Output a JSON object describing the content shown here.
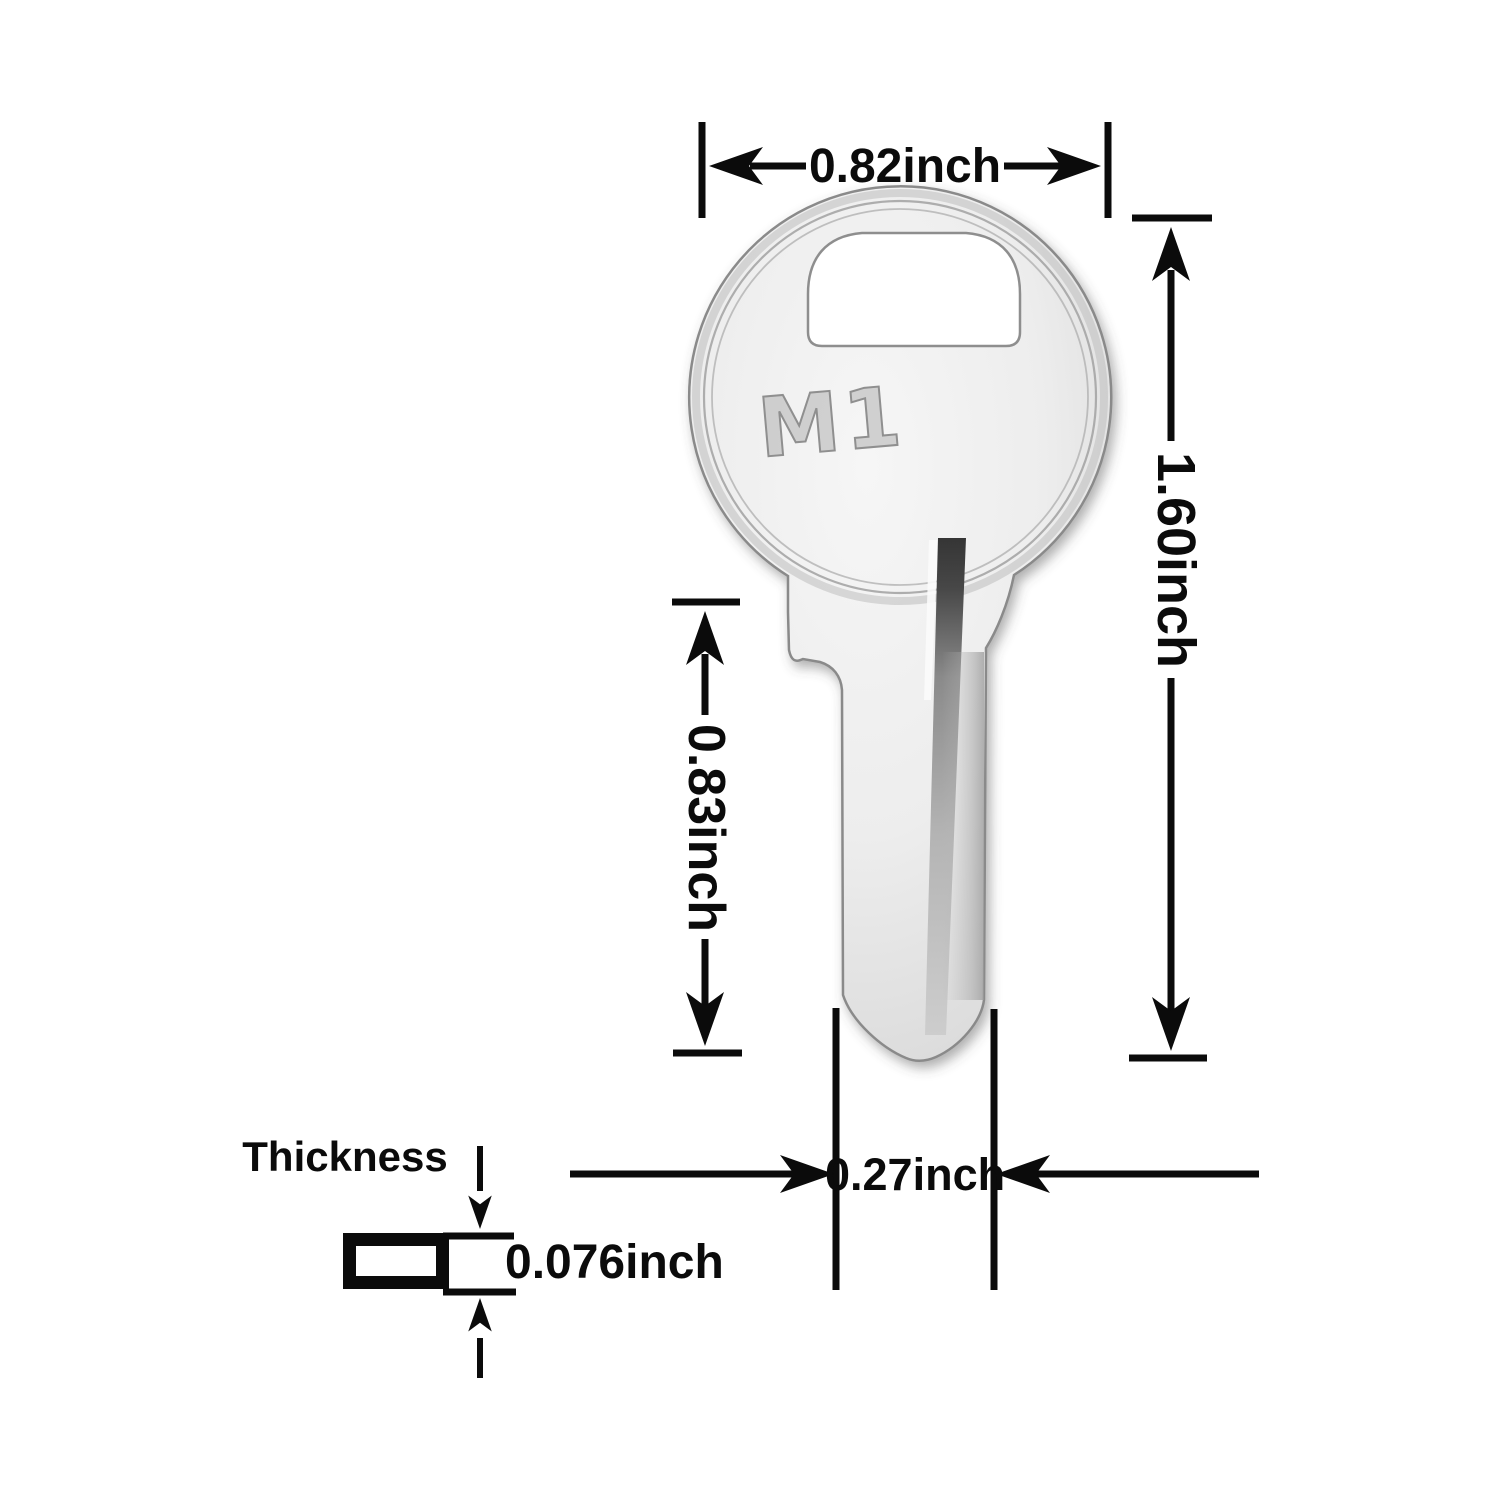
{
  "image": {
    "description": "Key blank dimension diagram",
    "background": "#ffffff",
    "annotation_color": "#0b0b0b",
    "metal_light": "#f3f3f3",
    "metal_mid": "#e2e2e2",
    "metal_dark": "#c9c9c9",
    "groove_dark": "#3c3c3c"
  },
  "key": {
    "stamp": "M1"
  },
  "dimensions": {
    "head_width": "0.82inch",
    "total_length": "1.60inch",
    "blade_length": "0.83inch",
    "blade_width": "0.27inch",
    "thickness_label": "Thickness",
    "thickness_value": "0.076inch"
  }
}
